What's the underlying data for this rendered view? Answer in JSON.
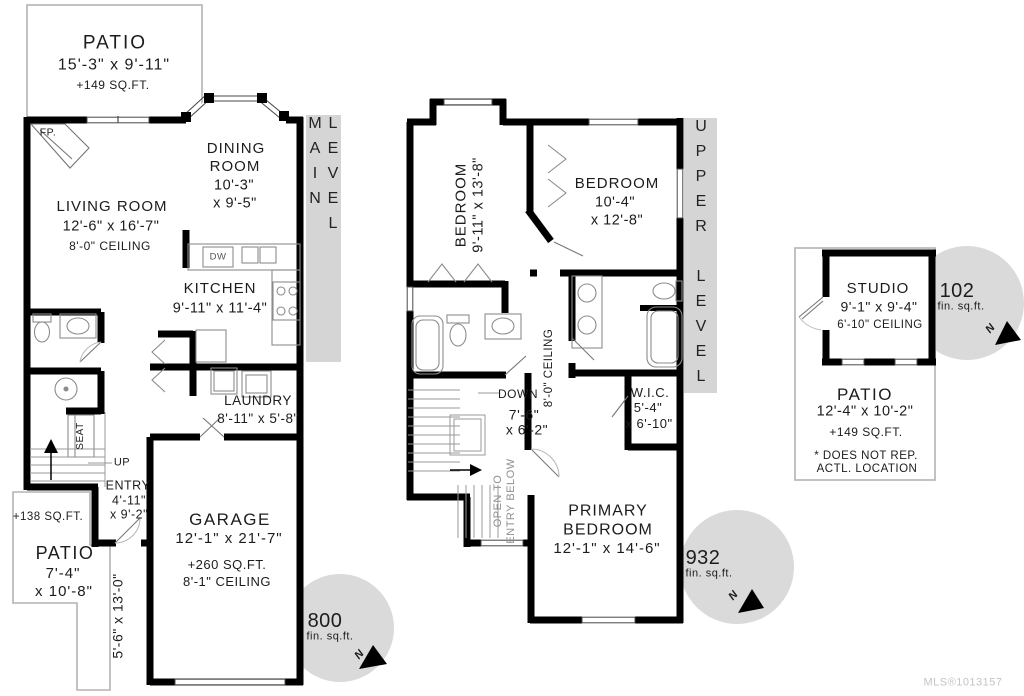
{
  "main_level": {
    "band": "MAIN LEVEL",
    "patio_top": {
      "name": "PATIO",
      "dims": "15'-3\" x 9'-11\"",
      "area": "+149 SQ.FT."
    },
    "fireplace": "FP.",
    "living_room": {
      "name": "LIVING ROOM",
      "dims": "12'-6\" x 16'-7\"",
      "ceiling": "8'-0\" CEILING"
    },
    "dining_room": {
      "name1": "DINING",
      "name2": "ROOM",
      "dims1": "10'-3\"",
      "dims2": "x 9'-5\""
    },
    "kitchen": {
      "name": "KITCHEN",
      "dims": "9'-11\" x 11'-4\"",
      "dishwasher": "DW"
    },
    "laundry": {
      "name": "LAUNDRY",
      "dims": "8'-11\" x 5'-8\""
    },
    "seat": "SEAT",
    "up": "UP",
    "entry": {
      "name": "ENTRY",
      "dims1": "4'-11\"",
      "dims2": "x 9'-2\""
    },
    "patio_lower": {
      "area": "+138 SQ.FT.",
      "name": "PATIO",
      "dims1": "7'-4\"",
      "dims2": "x 10'-8\"",
      "side_dims": "5'-6\" x 13'-0\""
    },
    "garage": {
      "name": "GARAGE",
      "dims": "12'-1\" x 21'-7\"",
      "area": "+260 SQ.FT.",
      "ceiling": "8'-1\" CEILING"
    },
    "area_badge": {
      "value": "800",
      "unit": "fin. sq.ft."
    },
    "north": "N"
  },
  "upper_level": {
    "band": "UPPER LEVEL",
    "bedroom_left": {
      "name": "BEDROOM",
      "dims": "9'-11\" x 13'-8\""
    },
    "bedroom_right": {
      "name": "BEDROOM",
      "dims1": "10'-4\"",
      "dims2": "x 12'-8\""
    },
    "ceiling": "8'-0\" CEILING",
    "stairs": {
      "down": "DOWN",
      "dims1": "7'-6\"",
      "dims2": "x 6'-2\""
    },
    "wic": {
      "name": "W.I.C.",
      "dims1": "5'-4\"",
      "dims2": "x 6'-10\""
    },
    "open_below": {
      "line1": "OPEN TO",
      "line2": "ENTRY BELOW"
    },
    "primary_bedroom": {
      "name1": "PRIMARY",
      "name2": "BEDROOM",
      "dims": "12'-1\" x 14'-6\""
    },
    "area_badge": {
      "value": "932",
      "unit": "fin. sq.ft."
    },
    "north": "N"
  },
  "studio": {
    "room": {
      "name": "STUDIO",
      "dims": "9'-1\" x 9'-4\"",
      "ceiling": "6'-10\" CEILING"
    },
    "patio": {
      "name": "PATIO",
      "dims": "12'-4\" x 10'-2\"",
      "area": "+149 SQ.FT."
    },
    "note1": "* DOES NOT REP.",
    "note2": "ACTL. LOCATION",
    "area_badge": {
      "value": "102",
      "unit": "fin. sq.ft."
    },
    "north": "N"
  },
  "footer": {
    "mls": "MLS®1013157"
  },
  "colors": {
    "wall": "#000000",
    "band": "#d5d5d5",
    "badge": "#dadada",
    "patio_outline": "#b3b3b3",
    "text": "#1c1c1c"
  }
}
